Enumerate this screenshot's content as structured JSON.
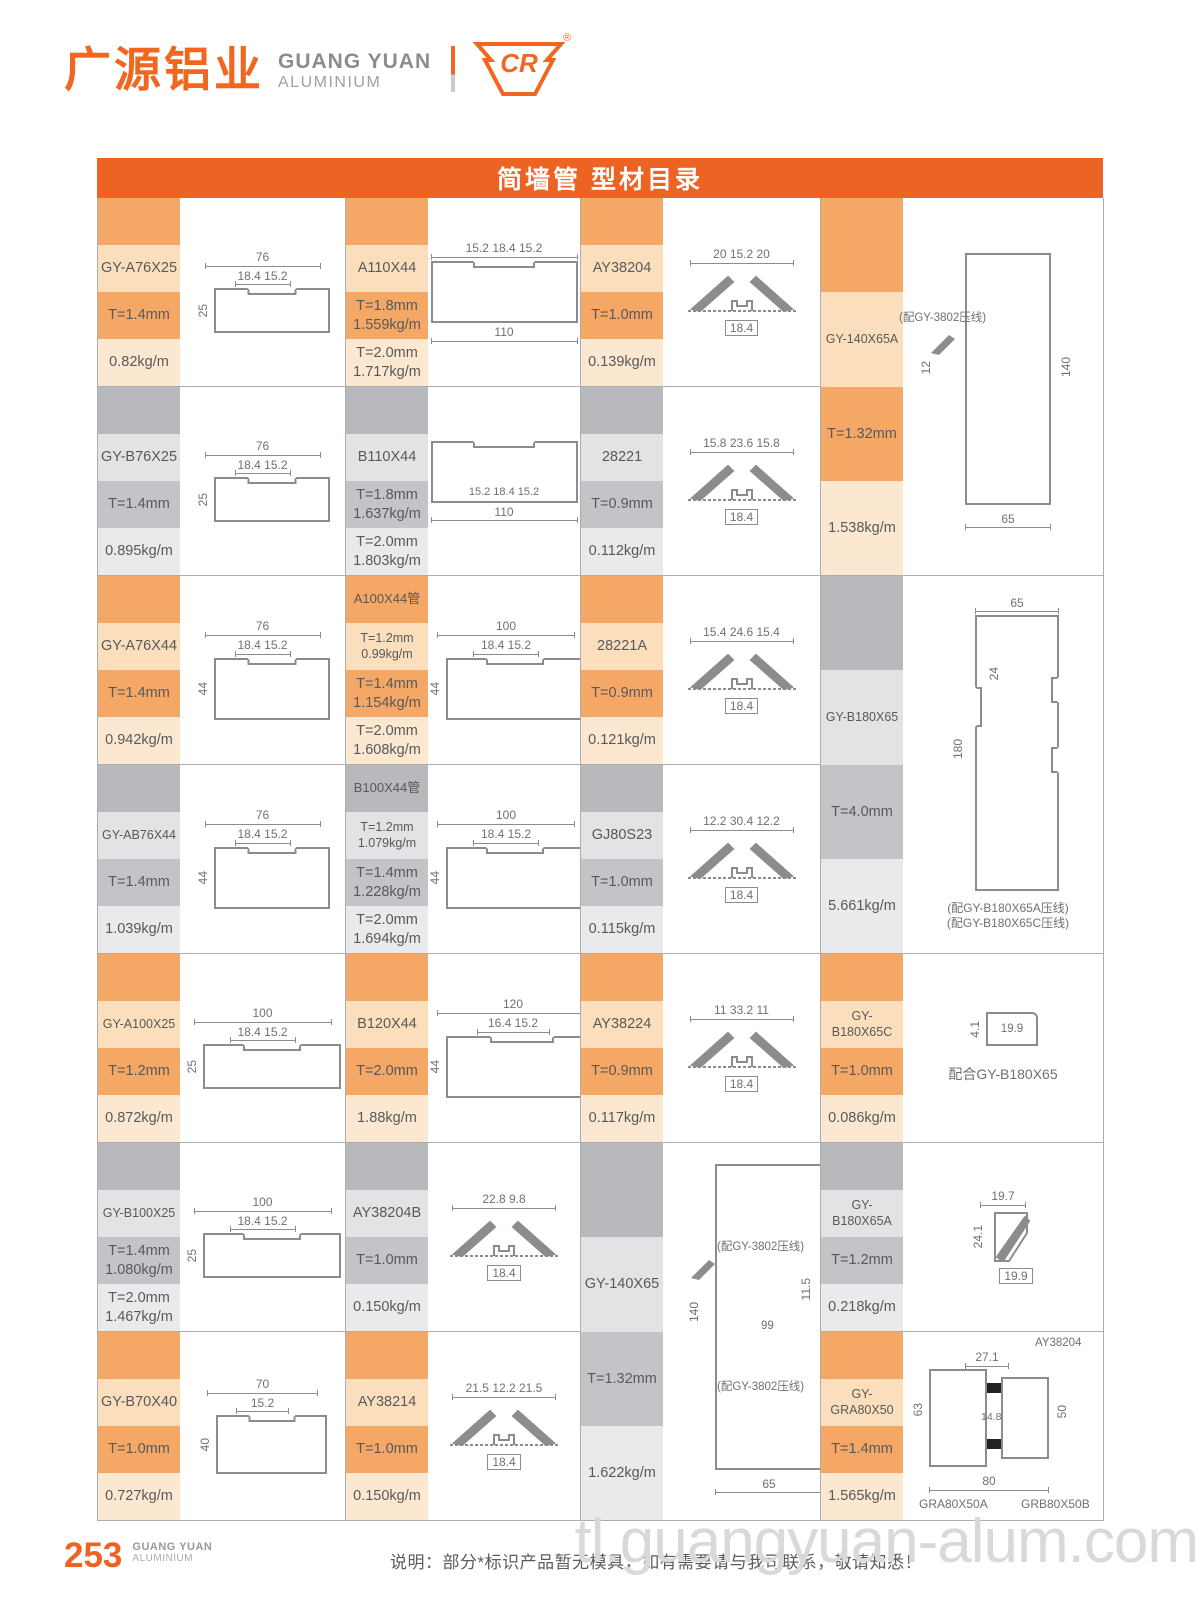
{
  "header": {
    "logo_cn": "广源铝业",
    "logo_en_line1": "GUANG YUAN",
    "logo_en_line2": "ALUMINIUM",
    "cr_text": "CR",
    "registered_mark": "®"
  },
  "title_bar": {
    "text": "简墙管 型材目录"
  },
  "colors": {
    "brand_orange": "#ED6323",
    "orange_dark": "#F5A765",
    "orange_light": "#FCE8D1",
    "gray_dark": "#B7B9BC",
    "gray_light": "#E9EAEB",
    "line_gray": "#8A8C8E"
  },
  "products": [
    {
      "name": "GY-A76X25",
      "theme": "orange",
      "cells": [
        "",
        "GY-A76X25",
        "T=1.4mm",
        "0.82kg/m"
      ],
      "drawing": {
        "type": "tube",
        "top": "76",
        "top2": "18.4 15.2",
        "left": "25"
      }
    },
    {
      "name": "A110X44",
      "theme": "orange",
      "cells": [
        "",
        "A110X44",
        "T=1.8mm\n1.559kg/m",
        "T=2.0mm\n1.717kg/m"
      ],
      "drawing": {
        "type": "tube",
        "top": "15.2 18.4 15.2",
        "bottom": "110",
        "wdim": "110",
        "hdim": "44"
      }
    },
    {
      "name": "AY38204",
      "theme": "orange",
      "cells": [
        "",
        "AY38204",
        "T=1.0mm",
        "0.139kg/m"
      ],
      "drawing": {
        "type": "clip",
        "top": "20 15.2 20",
        "mid": "18.4"
      }
    },
    {
      "name": "GY-140X65A",
      "theme": "orange",
      "cells": [
        "",
        "GY-140X65A",
        "T=1.32mm",
        "1.538kg/m"
      ],
      "drawing": {
        "type": "tallA",
        "right": "140",
        "left": "12",
        "bottom": "65",
        "note": "(配GY-3802压线)"
      }
    },
    {
      "name": "GY-B76X25",
      "theme": "gray",
      "cells": [
        "",
        "GY-B76X25",
        "T=1.4mm",
        "0.895kg/m"
      ],
      "drawing": {
        "type": "tube",
        "top": "76",
        "top2": "18.4 15.2",
        "left": "25"
      }
    },
    {
      "name": "B110X44",
      "theme": "gray",
      "cells": [
        "",
        "B110X44",
        "T=1.8mm\n1.637kg/m",
        "T=2.0mm\n1.803kg/m"
      ],
      "drawing": {
        "type": "tube",
        "mid": "15.2 18.4 15.2",
        "bottom": "110",
        "wdim": "110",
        "hdim": "44"
      }
    },
    {
      "name": "28221",
      "theme": "gray",
      "cells": [
        "",
        "28221",
        "T=0.9mm",
        "0.112kg/m"
      ],
      "drawing": {
        "type": "clip",
        "top": "15.8 23.6 15.8",
        "mid": "18.4"
      }
    },
    {
      "name": "GY-A76X44",
      "theme": "orange",
      "cells": [
        "",
        "GY-A76X44",
        "T=1.4mm",
        "0.942kg/m"
      ],
      "drawing": {
        "type": "tube",
        "top": "76",
        "top2": "18.4 15.2",
        "left": "44"
      }
    },
    {
      "name": "A100X44管",
      "theme": "orange",
      "cells": [
        "A100X44管",
        "T=1.2mm\n0.99kg/m",
        "T=1.4mm\n1.154kg/m",
        "T=2.0mm\n1.608kg/m"
      ],
      "drawing": {
        "type": "tube",
        "top": "100",
        "top2": "18.4 15.2",
        "left": "44"
      }
    },
    {
      "name": "28221A",
      "theme": "orange",
      "cells": [
        "",
        "28221A",
        "T=0.9mm",
        "0.121kg/m"
      ],
      "drawing": {
        "type": "clip",
        "top": "15.4 24.6 15.4",
        "mid": "18.4"
      }
    },
    {
      "name": "GY-B180X65",
      "theme": "gray",
      "cells": [
        "",
        "GY-B180X65",
        "T=4.0mm",
        "5.661kg/m"
      ],
      "drawing": {
        "type": "tallB",
        "top": "65",
        "left": "180",
        "left2": "24",
        "captions": [
          "(配GY-B180X65A压线)",
          "(配GY-B180X65C压线)"
        ]
      }
    },
    {
      "name": "GY-AB76X44",
      "theme": "gray",
      "cells": [
        "",
        "GY-AB76X44",
        "T=1.4mm",
        "1.039kg/m"
      ],
      "drawing": {
        "type": "tube",
        "top": "76",
        "top2": "18.4 15.2",
        "left": "44"
      }
    },
    {
      "name": "B100X44管",
      "theme": "gray",
      "cells": [
        "B100X44管",
        "T=1.2mm\n1.079kg/m",
        "T=1.4mm\n1.228kg/m",
        "T=2.0mm\n1.694kg/m"
      ],
      "drawing": {
        "type": "tube",
        "top": "100",
        "top2": "18.4 15.2",
        "left": "44"
      }
    },
    {
      "name": "GJ80S23",
      "theme": "gray",
      "cells": [
        "",
        "GJ80S23",
        "T=1.0mm",
        "0.115kg/m"
      ],
      "drawing": {
        "type": "clip",
        "top": "12.2 30.4 12.2",
        "mid": "18.4"
      }
    },
    {
      "name": "GY-A100X25",
      "theme": "orange",
      "cells": [
        "",
        "GY-A100X25",
        "T=1.2mm",
        "0.872kg/m"
      ],
      "drawing": {
        "type": "tube",
        "top": "100",
        "top2": "18.4 15.2",
        "left": "25"
      }
    },
    {
      "name": "B120X44",
      "theme": "orange",
      "cells": [
        "",
        "B120X44",
        "T=2.0mm",
        "1.88kg/m"
      ],
      "drawing": {
        "type": "tube",
        "top": "120",
        "top2": "16.4 15.2",
        "left": "44"
      }
    },
    {
      "name": "AY38224",
      "theme": "orange",
      "cells": [
        "",
        "AY38224",
        "T=0.9mm",
        "0.117kg/m"
      ],
      "drawing": {
        "type": "clip",
        "top": "11 33.2 11",
        "mid": "18.4"
      }
    },
    {
      "name": "GY-B180X65C",
      "theme": "orange",
      "cells": [
        "",
        "GY-B180X65C",
        "T=1.0mm",
        "0.086kg/m"
      ],
      "drawing": {
        "type": "smallC",
        "left": "4.1",
        "box": "19.9",
        "caption": "配合GY-B180X65"
      }
    },
    {
      "name": "GY-B100X25",
      "theme": "gray",
      "cells": [
        "",
        "GY-B100X25",
        "T=1.4mm\n1.080kg/m",
        "T=2.0mm\n1.467kg/m"
      ],
      "drawing": {
        "type": "tube",
        "top": "100",
        "top2": "18.4 15.2",
        "left": "25"
      }
    },
    {
      "name": "AY38204B",
      "theme": "gray",
      "cells": [
        "",
        "AY38204B",
        "T=1.0mm",
        "0.150kg/m"
      ],
      "drawing": {
        "type": "clip",
        "top": "22.8 9.8",
        "mid": "18.4"
      }
    },
    {
      "name": "GY-140X65",
      "theme": "gray",
      "cells": [
        "",
        "GY-140X65",
        "T=1.32mm",
        "1.622kg/m"
      ],
      "drawing": {
        "type": "tallC",
        "left": "140",
        "mid_rot": "11.5",
        "mid": "99",
        "bottom": "65",
        "notes": [
          "(配GY-3802压线)",
          "(配GY-3802压线)"
        ]
      }
    },
    {
      "name": "GY-B180X65A",
      "theme": "gray",
      "cells": [
        "",
        "GY-B180X65A",
        "T=1.2mm",
        "0.218kg/m"
      ],
      "drawing": {
        "type": "smallA",
        "top": "19.7",
        "left": "24.1",
        "bottom": "19.9"
      }
    },
    {
      "name": "GY-B70X40",
      "theme": "orange",
      "cells": [
        "",
        "GY-B70X40",
        "T=1.0mm",
        "0.727kg/m"
      ],
      "drawing": {
        "type": "tube",
        "top": "70",
        "top2": "15.2",
        "left": "40"
      }
    },
    {
      "name": "AY38214",
      "theme": "orange",
      "cells": [
        "",
        "AY38214",
        "T=1.0mm",
        "0.150kg/m"
      ],
      "drawing": {
        "type": "clip",
        "top": "21.5 12.2 21.5",
        "mid": "18.4"
      }
    },
    {
      "name": "GY-GRA80X50",
      "theme": "orange",
      "cells": [
        "",
        "GY-GRA80X50",
        "T=1.4mm",
        "1.565kg/m"
      ],
      "drawing": {
        "type": "comp",
        "callout": "AY38204",
        "top": "27.1",
        "left": "63",
        "mid": "14.8",
        "right": "50",
        "bottom": "80",
        "captions": [
          "GRA80X50A",
          "GRB80X50B"
        ]
      }
    }
  ],
  "footer": {
    "page_number": "253",
    "brand_line1": "GUANG YUAN",
    "brand_line2": "ALUMINIUM",
    "note": "说明：部分*标识产品暂无模具，如有需要请与我司联系，敬请知悉！",
    "watermark": "tl.guangyuan-alum.com"
  }
}
